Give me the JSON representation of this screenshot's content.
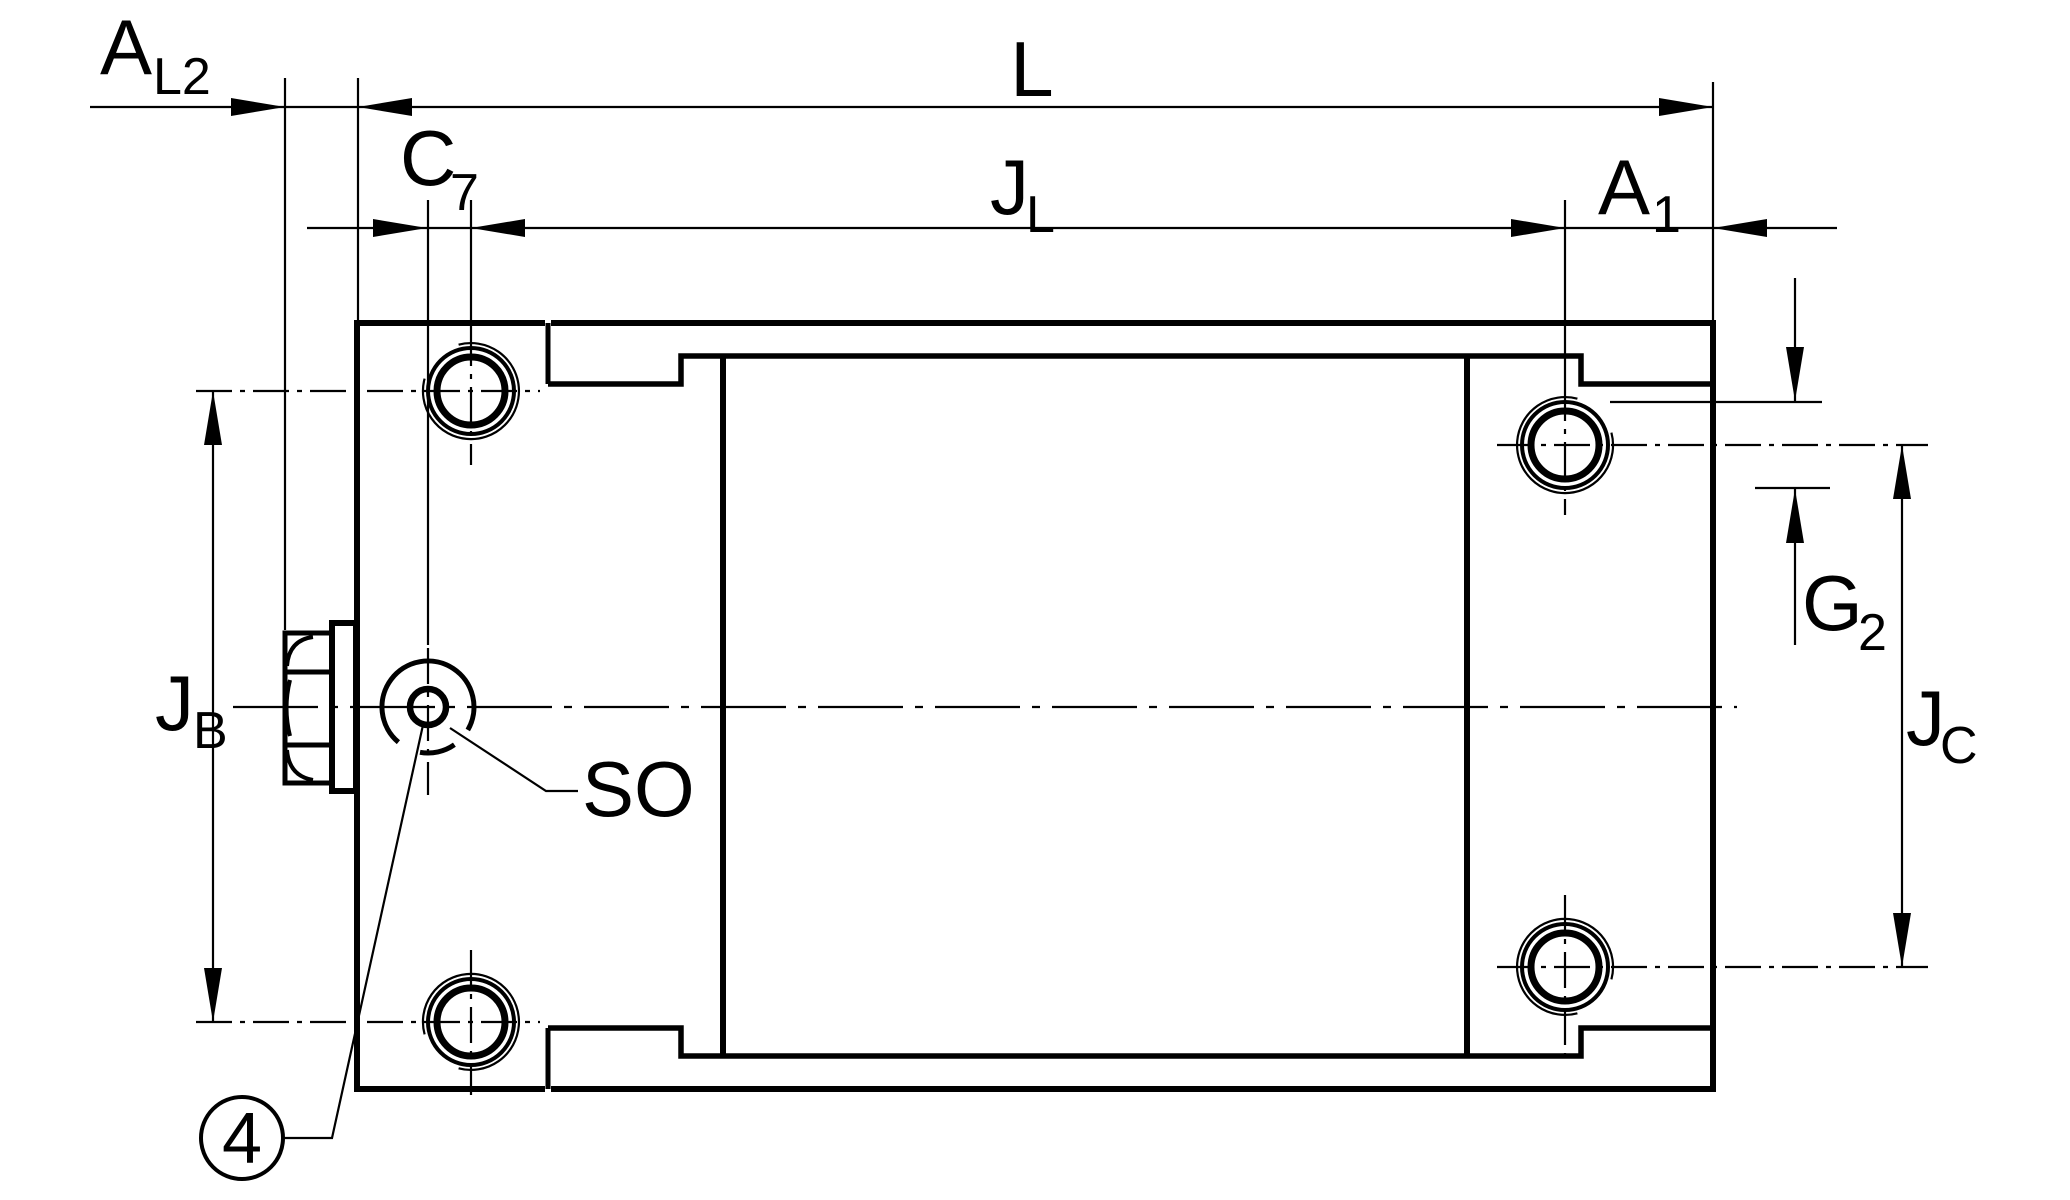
{
  "drawing": {
    "kind": "technical-dimension-drawing",
    "colors": {
      "line": "#000000",
      "background": "#ffffff"
    },
    "labels": {
      "al2": {
        "main": "A",
        "sub": "L2"
      },
      "l": {
        "main": "L"
      },
      "c7": {
        "main": "C",
        "sub": "7"
      },
      "jl": {
        "main": "J",
        "sub": "L"
      },
      "a1": {
        "main": "A",
        "sub": "1"
      },
      "g2": {
        "main": "G",
        "sub": "2"
      },
      "jb": {
        "main": "J",
        "sub": "B"
      },
      "jc": {
        "main": "J",
        "sub": "C"
      },
      "so": {
        "main": "SO"
      },
      "balloon": {
        "number": "4"
      }
    }
  }
}
